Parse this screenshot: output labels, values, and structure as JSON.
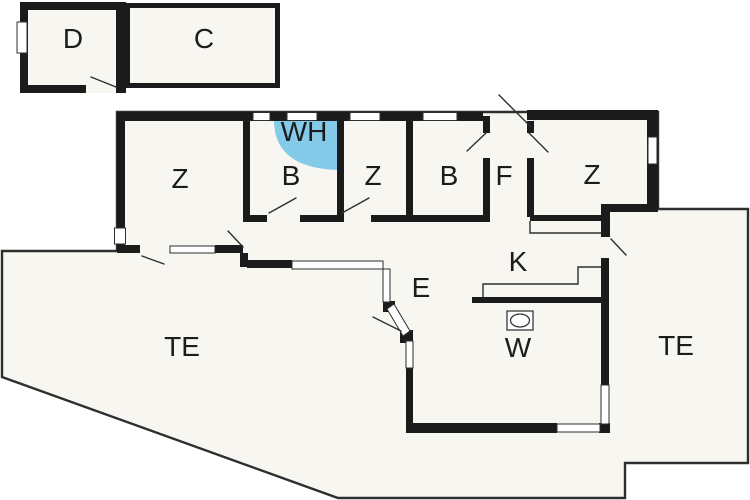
{
  "colors": {
    "wall": "#1b1b1b",
    "line": "#2e2e2e",
    "plan_fill": "#f7f6f1",
    "window_fill": "#ffffff",
    "shower_fill": "#84cbe9",
    "label": "#1c1c1c",
    "background": "#ffffff"
  },
  "labels": [
    {
      "id": "room-d",
      "text": "D"
    },
    {
      "id": "room-c",
      "text": "C"
    },
    {
      "id": "room-z1",
      "text": "Z"
    },
    {
      "id": "room-wh",
      "text": "WH"
    },
    {
      "id": "room-b1",
      "text": "B"
    },
    {
      "id": "room-z2",
      "text": "Z"
    },
    {
      "id": "room-b2",
      "text": "B"
    },
    {
      "id": "room-f",
      "text": "F"
    },
    {
      "id": "room-z3",
      "text": "Z"
    },
    {
      "id": "room-e",
      "text": "E"
    },
    {
      "id": "room-k",
      "text": "K"
    },
    {
      "id": "room-w",
      "text": "W"
    },
    {
      "id": "terrace-left",
      "text": "TE"
    },
    {
      "id": "terrace-right",
      "text": "TE"
    }
  ]
}
